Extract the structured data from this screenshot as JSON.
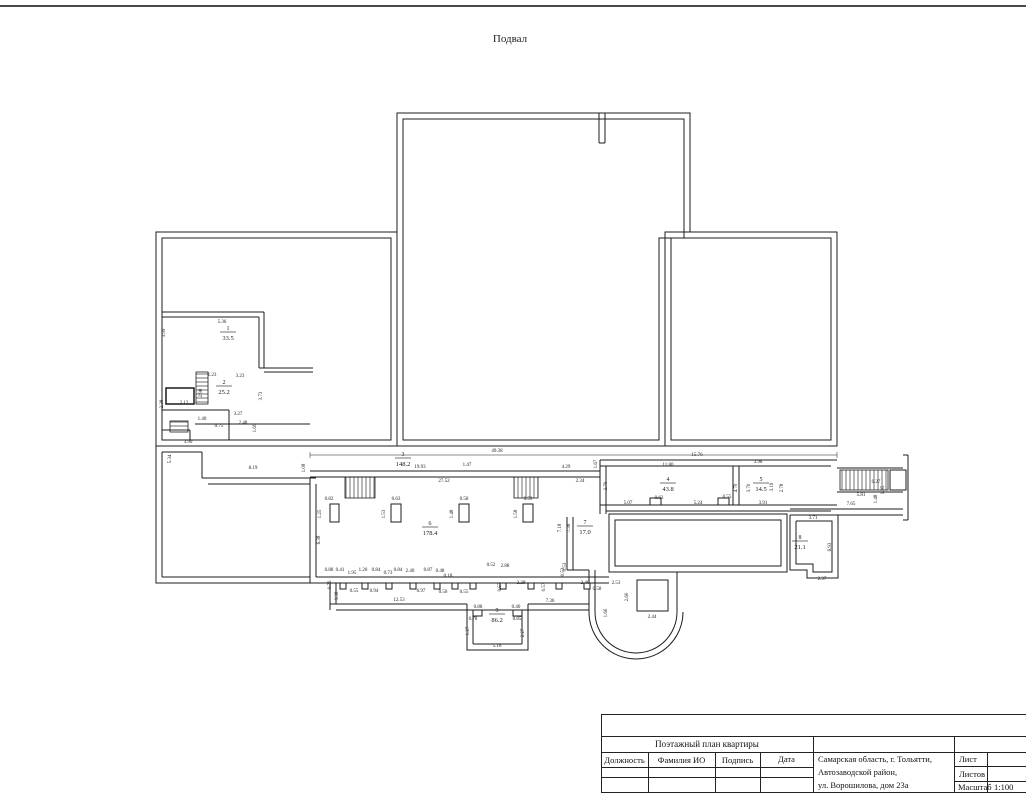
{
  "page": {
    "plan_title": "Подвал"
  },
  "plan": {
    "rooms": [
      {
        "n": "1",
        "a": "33.5",
        "x": 228,
        "y": 332
      },
      {
        "n": "2",
        "a": "25.2",
        "x": 224,
        "y": 386
      },
      {
        "n": "3",
        "a": "148.2",
        "x": 403,
        "y": 458
      },
      {
        "n": "4",
        "a": "43.8",
        "x": 668,
        "y": 483
      },
      {
        "n": "5",
        "a": "14.5",
        "x": 761,
        "y": 483
      },
      {
        "n": "6",
        "a": "178.4",
        "x": 430,
        "y": 527
      },
      {
        "n": "7",
        "a": "17.0",
        "x": 585,
        "y": 526
      },
      {
        "n": "8",
        "a": "21.1",
        "x": 800,
        "y": 541
      },
      {
        "n": "9",
        "a": "86.2",
        "x": 497,
        "y": 614
      }
    ],
    "dims": [
      {
        "t": "49.38",
        "x": 497,
        "y": 452
      },
      {
        "t": "19.93",
        "x": 420,
        "y": 468
      },
      {
        "t": "1.47",
        "x": 467,
        "y": 466
      },
      {
        "t": "4.29",
        "x": 566,
        "y": 468
      },
      {
        "t": "27.52",
        "x": 444,
        "y": 482
      },
      {
        "t": "2.34",
        "x": 580,
        "y": 482
      },
      {
        "t": "1.67",
        "x": 597,
        "y": 464,
        "r": -90
      },
      {
        "t": "15.76",
        "x": 697,
        "y": 456
      },
      {
        "t": "11.80",
        "x": 668,
        "y": 466
      },
      {
        "t": "3.98",
        "x": 758,
        "y": 463
      },
      {
        "t": "5.36",
        "x": 222,
        "y": 323
      },
      {
        "t": "3.99",
        "x": 165,
        "y": 333,
        "r": -90
      },
      {
        "t": "1.23",
        "x": 212,
        "y": 376
      },
      {
        "t": "3.23",
        "x": 240,
        "y": 377
      },
      {
        "t": "2.90",
        "x": 202,
        "y": 393,
        "r": -90
      },
      {
        "t": "3.73",
        "x": 262,
        "y": 396,
        "r": -90
      },
      {
        "t": "2.12",
        "x": 184,
        "y": 404
      },
      {
        "t": "2.38",
        "x": 163,
        "y": 404,
        "r": -90
      },
      {
        "t": "3.27",
        "x": 238,
        "y": 415
      },
      {
        "t": "1.40",
        "x": 202,
        "y": 420
      },
      {
        "t": "0.75",
        "x": 219,
        "y": 427
      },
      {
        "t": "2.48",
        "x": 243,
        "y": 424
      },
      {
        "t": "1.69",
        "x": 256,
        "y": 428,
        "r": -90
      },
      {
        "t": "3.90",
        "x": 188,
        "y": 443
      },
      {
        "t": "5.34",
        "x": 171,
        "y": 459,
        "r": -90
      },
      {
        "t": "8.19",
        "x": 253,
        "y": 469
      },
      {
        "t": "1.08",
        "x": 305,
        "y": 468,
        "r": -90
      },
      {
        "t": "0.82",
        "x": 329,
        "y": 500
      },
      {
        "t": "1.25",
        "x": 321,
        "y": 514,
        "r": -90
      },
      {
        "t": "6.38",
        "x": 320,
        "y": 540,
        "r": -90
      },
      {
        "t": "0.63",
        "x": 396,
        "y": 500
      },
      {
        "t": "1.53",
        "x": 385,
        "y": 514,
        "r": -90
      },
      {
        "t": "0.58",
        "x": 464,
        "y": 500
      },
      {
        "t": "1.48",
        "x": 453,
        "y": 514,
        "r": -90
      },
      {
        "t": "0.59",
        "x": 528,
        "y": 500
      },
      {
        "t": "1.58",
        "x": 517,
        "y": 514,
        "r": -90
      },
      {
        "t": "3.70",
        "x": 607,
        "y": 486,
        "r": -90
      },
      {
        "t": "5.07",
        "x": 628,
        "y": 504
      },
      {
        "t": "0.63",
        "x": 659,
        "y": 499
      },
      {
        "t": "5.24",
        "x": 698,
        "y": 504
      },
      {
        "t": "0.55",
        "x": 727,
        "y": 498
      },
      {
        "t": "3.91",
        "x": 763,
        "y": 504
      },
      {
        "t": "4.70",
        "x": 737,
        "y": 488,
        "r": -90
      },
      {
        "t": "3.70",
        "x": 750,
        "y": 488,
        "r": -90
      },
      {
        "t": "2.78",
        "x": 783,
        "y": 488,
        "r": -90
      },
      {
        "t": "0.27",
        "x": 876,
        "y": 483
      },
      {
        "t": "5.81",
        "x": 861,
        "y": 496
      },
      {
        "t": "1.48",
        "x": 877,
        "y": 499,
        "r": -90
      },
      {
        "t": "7.65",
        "x": 851,
        "y": 505
      },
      {
        "t": "1.95",
        "x": 884,
        "y": 490,
        "r": -90
      },
      {
        "t": "3.19",
        "x": 773,
        "y": 487,
        "r": -90
      },
      {
        "t": "3.71",
        "x": 813,
        "y": 519
      },
      {
        "t": "6.93",
        "x": 831,
        "y": 547,
        "r": -90
      },
      {
        "t": "2.37",
        "x": 822,
        "y": 580
      },
      {
        "t": "7.18",
        "x": 561,
        "y": 528,
        "r": -90
      },
      {
        "t": "7.38",
        "x": 570,
        "y": 528,
        "r": -90
      },
      {
        "t": "0.53",
        "x": 564,
        "y": 572,
        "r": -90
      },
      {
        "t": "0.88",
        "x": 329,
        "y": 571
      },
      {
        "t": "0.41",
        "x": 340,
        "y": 571
      },
      {
        "t": "1.95",
        "x": 352,
        "y": 574
      },
      {
        "t": "1.20",
        "x": 363,
        "y": 571
      },
      {
        "t": "0.84",
        "x": 376,
        "y": 571
      },
      {
        "t": "0.73",
        "x": 388,
        "y": 574
      },
      {
        "t": "0.84",
        "x": 398,
        "y": 571
      },
      {
        "t": "2.40",
        "x": 410,
        "y": 572
      },
      {
        "t": "0.87",
        "x": 428,
        "y": 571
      },
      {
        "t": "0.48",
        "x": 440,
        "y": 572
      },
      {
        "t": "0.18",
        "x": 448,
        "y": 577
      },
      {
        "t": "0.76",
        "x": 331,
        "y": 585,
        "r": -90
      },
      {
        "t": "0.55",
        "x": 354,
        "y": 592
      },
      {
        "t": "0.94",
        "x": 374,
        "y": 592
      },
      {
        "t": "6.97",
        "x": 421,
        "y": 592
      },
      {
        "t": "0.50",
        "x": 443,
        "y": 593
      },
      {
        "t": "0.55",
        "x": 464,
        "y": 593
      },
      {
        "t": "3.38",
        "x": 338,
        "y": 596,
        "r": -90
      },
      {
        "t": "12.53",
        "x": 399,
        "y": 601
      },
      {
        "t": "0.52",
        "x": 491,
        "y": 566
      },
      {
        "t": "2.88",
        "x": 505,
        "y": 567
      },
      {
        "t": "0.53",
        "x": 566,
        "y": 567,
        "r": -90
      },
      {
        "t": "0.57",
        "x": 501,
        "y": 587,
        "r": -90
      },
      {
        "t": "2.29",
        "x": 521,
        "y": 584
      },
      {
        "t": "0.57",
        "x": 545,
        "y": 587,
        "r": -90
      },
      {
        "t": "2.40",
        "x": 585,
        "y": 584
      },
      {
        "t": "0.58",
        "x": 597,
        "y": 590
      },
      {
        "t": "2.53",
        "x": 616,
        "y": 584
      },
      {
        "t": "2.60",
        "x": 628,
        "y": 597,
        "r": -90
      },
      {
        "t": "1.60",
        "x": 607,
        "y": 613,
        "r": -90
      },
      {
        "t": "2.44",
        "x": 652,
        "y": 618
      },
      {
        "t": "7.36",
        "x": 550,
        "y": 602
      },
      {
        "t": "0.88",
        "x": 478,
        "y": 608
      },
      {
        "t": "0.40",
        "x": 516,
        "y": 608
      },
      {
        "t": "0.78",
        "x": 473,
        "y": 620
      },
      {
        "t": "0.85",
        "x": 517,
        "y": 620
      },
      {
        "t": "1.27",
        "x": 469,
        "y": 631,
        "r": -90
      },
      {
        "t": "2.27",
        "x": 524,
        "y": 633,
        "r": -90
      },
      {
        "t": "5.16",
        "x": 497,
        "y": 647
      }
    ]
  },
  "title_block": {
    "doc_title": "Поэтажный план квартиры",
    "col_headers": [
      "Должность",
      "Фамилия ИО",
      "Подпись",
      "Дата"
    ],
    "address_lines": [
      "Самарская область, г. Тольятти,",
      "Автозаводской   район,",
      "ул. Ворошилова, дом 23а"
    ],
    "sheet_label": "Лист",
    "sheets_label": "Листов",
    "scale_label": "Масштаб",
    "scale_value": "1:100"
  }
}
